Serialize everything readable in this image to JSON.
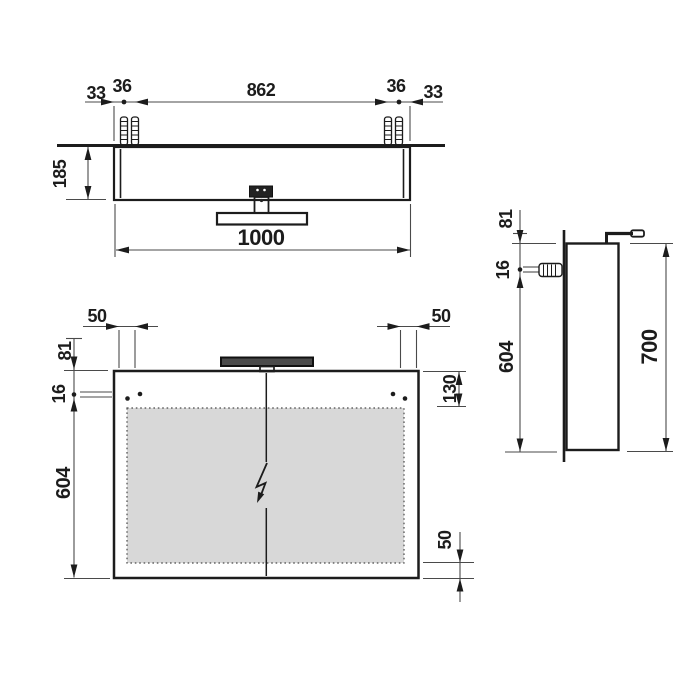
{
  "drawing": {
    "type": "technical-dimension-drawing",
    "subject": "mirror-cabinet-with-light-fixture",
    "top_view": {
      "offset_left": "33",
      "anchor_gap_left": "36",
      "anchor_span": "862",
      "anchor_gap_right": "36",
      "offset_right": "33",
      "depth": "185",
      "width_overall": "1000"
    },
    "front_view": {
      "edge_offset_left": "50",
      "edge_offset_right": "50",
      "lamp_to_top": "81",
      "hole_offset": "16",
      "hole_to_bottom": "604",
      "top_inset": "130",
      "bottom_inset": "50"
    },
    "side_view": {
      "lamp_to_top": "81",
      "hole_offset": "16",
      "hole_to_bottom": "604",
      "height_overall": "700"
    },
    "icons": {
      "electrical_connection": "lightning-bolt",
      "wall_plug": "ribbed-anchor"
    },
    "colors": {
      "object_line": "#1c1c1c",
      "dimension_line": "#4a4a4a",
      "mirror_fill": "#d8d8d8",
      "lamp_fill": "#4a4a4a",
      "background": "#ffffff"
    }
  }
}
